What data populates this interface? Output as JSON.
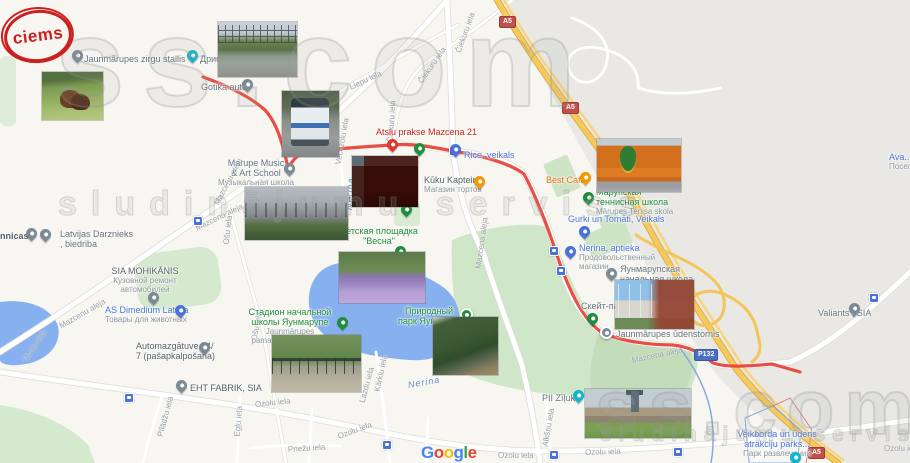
{
  "logo": {
    "text": "ciems"
  },
  "watermark": {
    "brand": "ss.com",
    "tagline": "sludinājumu serviss"
  },
  "attribution": {
    "letters": [
      "G",
      "o",
      "o",
      "g",
      "l",
      "e"
    ]
  },
  "badges": {
    "a5": "A5",
    "p132": "P132"
  },
  "river": {
    "name": "Nerina"
  },
  "streets": [
    "Mazcenu aleja",
    "Ozolu iela",
    "Ošu iela",
    "Liepu iela",
    "Čiekuru iela",
    "Vecozolu iela",
    "Mazcena aleja",
    "Pīlādžu iela",
    "Egļu iela",
    "Priežu iela",
    "Kārklu iela",
    "Lazdu iela",
    "Alkšņu iela"
  ],
  "pois": {
    "zirgu_stallis": {
      "name": "Jaunmārupes zirgu stallis"
    },
    "drift": {
      "name": "Дрифт"
    },
    "gotika_auto": {
      "name": "Gotika auto"
    },
    "marupe_music": {
      "line1": "Marupe Music",
      "line2": "& Art School",
      "sub": "Музыкальная школа"
    },
    "met": {
      "name": "Met"
    },
    "atslu_prakse": {
      "name": "Atslu prakse Mazcena 21"
    },
    "rice": {
      "name": "Rice, veikals"
    },
    "kuku_kapteine": {
      "name": "Kūku Kapteine",
      "sub": "Магазин тортов"
    },
    "cafe_laura": {
      "name": "cafe Laura"
    },
    "best_cafe": {
      "name": "Best Cafe"
    },
    "tennis_school": {
      "line1": "Марупская",
      "line2": "теннисная школа",
      "sub": "Mārupes Tenisa skola"
    },
    "gurki": {
      "name": "Gurki un Tomāti, Veikals"
    },
    "nerina_aptieka": {
      "name": "Nerina, aptieka",
      "sub1": "Продовольственный",
      "sub2": "магазин"
    },
    "jaunmarupe_school": {
      "line1": "Яунмарупская",
      "line2": "начальная школа"
    },
    "skate_park": {
      "name": "Скейт-парк"
    },
    "udenstornis": {
      "name": "Jaunmārupes ūdenstornis"
    },
    "mohikanis": {
      "name": "SIA MOHIKĀNIS",
      "sub1": "Кузовной ремонт",
      "sub2": "автомобилей"
    },
    "dimedium": {
      "name": "AS Dimedium Latvija",
      "sub": "Товары для животных"
    },
    "automazgatuve": {
      "line1": "Automazgātuve 24/",
      "line2": "7 (pašapkalpošana)"
    },
    "darznieks": {
      "line1": "Latvijas Darznieks",
      "line2": ", biedriba"
    },
    "nnicas": {
      "name": "nnicas"
    },
    "eht_fabrik": {
      "name": "EHT FABRIK, SIA"
    },
    "pii_ziluks": {
      "name": "PII Zīļuks"
    },
    "veikbords": {
      "line1": "Veikborda un ūdens",
      "line2": "atrakciju parks...",
      "sub": "Парк развлечений"
    },
    "valiants": {
      "name": "Valiants , SIA"
    },
    "avangards": {
      "name": "Ava...",
      "sub": "Посел..."
    },
    "vesna": {
      "line1": "Детская площадка",
      "line2": "\"Весна\""
    },
    "stadions": {
      "line1": "Стадион начальной",
      "line2": "школы Яунмарупе",
      "sub1": "Jaunmārupes",
      "sub2": "pamatskolas stadions"
    },
    "dabas_parks": {
      "line1": "Природный",
      "line2": "парк Яунмарупе"
    }
  },
  "colors": {
    "route_red": "#e8443a",
    "highway_yellow": "#f5ca58",
    "water_blue": "#87b0ef",
    "park_green": "#cfe7c8",
    "built_area_grey": "#e9e8e4",
    "logo_red": "#cc1f1f"
  }
}
